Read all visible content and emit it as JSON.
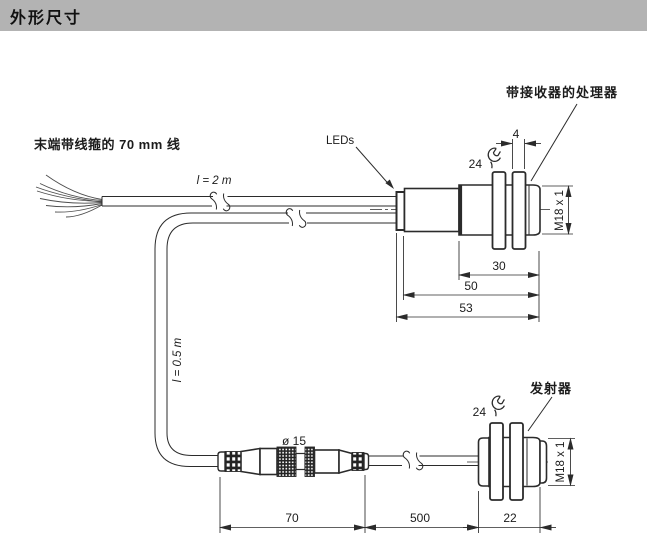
{
  "colors": {
    "header_bg": "#b3b3b3",
    "line": "#2b2b2b"
  },
  "header": {
    "title": "外形尺寸"
  },
  "labels": {
    "pigtail_wires": "末端带线箍的 70 mm 线",
    "cable_receiver_length": "l = 2 m",
    "cable_emitter_length": "l = 0.5 m",
    "leds": "LEDs",
    "receiver_unit": "带接收器的处理器",
    "emitter_unit": "发射器",
    "connector_diameter": "ø 15"
  },
  "dimensions": {
    "receiver": {
      "nut_thickness": "4",
      "wrench_size": "24",
      "thread": "M18 x 1",
      "thread_length": "30",
      "body_length": "50",
      "total_length": "53"
    },
    "emitter": {
      "wrench_size": "24",
      "thread": "M18 x 1",
      "width": "22"
    },
    "connector": {
      "length": "70",
      "cable_length": "500"
    }
  }
}
